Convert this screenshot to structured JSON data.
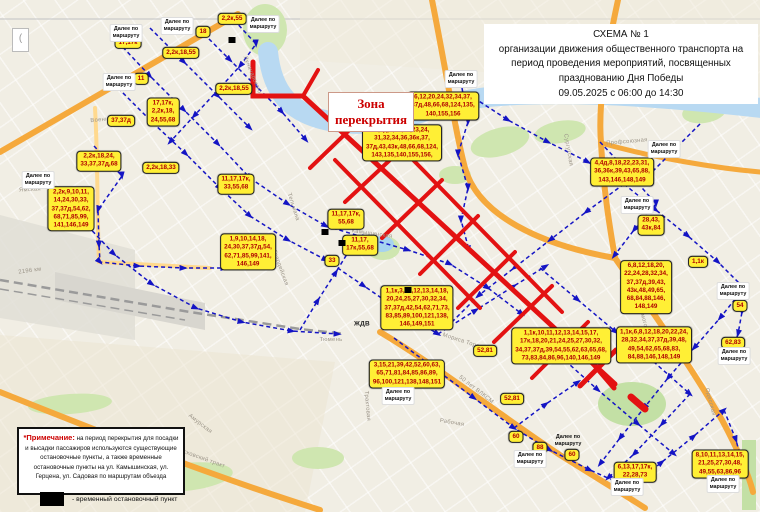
{
  "title": {
    "line1": "СХЕМА № 1",
    "line2": "организации движения общественного транспорта на",
    "line3": "период проведения мероприятий, посвященных",
    "line4": "празднованию Дня Победы",
    "line5": "09.05.2025 с 06:00 до 14:30"
  },
  "zone": {
    "line1": "Зона",
    "line2": "перекрытия"
  },
  "note": {
    "label": "*Примечание:",
    "body": " на период перекрытия для посадки и высадки пассажиров используются существующие остановочные пункты, а также временные остановочные пункты на ул. Камышинская, ул. Герцена, ул. Садовая по маршрутам объезда"
  },
  "legend": {
    "text": "- временный остановочный пункт"
  },
  "corner_glyph": "(",
  "colors": {
    "route_label_bg": "#ffef35",
    "route_label_text": "#b00000",
    "closure_red": "#e31212",
    "route_blue": "#1414c4",
    "road_orange": "#f5a93c",
    "river_blue": "#b8d9f2",
    "park_green": "#cfe6b0"
  },
  "map": {
    "info_label_text": "Далее по\nмаршруту",
    "route_labels": [
      {
        "t": "2,2к,55",
        "x": 232,
        "y": 19
      },
      {
        "t": "18",
        "x": 203,
        "y": 32
      },
      {
        "t": "17,17к",
        "x": 128,
        "y": 43
      },
      {
        "t": "2,2к,18,55",
        "x": 181,
        "y": 53
      },
      {
        "t": "11",
        "x": 141,
        "y": 79
      },
      {
        "t": "2,2к,18,55",
        "x": 234,
        "y": 89
      },
      {
        "t": "17,17к,\n2,2к,18,\n24,55,68",
        "x": 163,
        "y": 112
      },
      {
        "t": "37,37д",
        "x": 121,
        "y": 121
      },
      {
        "t": "2,2к,18,24,\n33,37,37д,68",
        "x": 99,
        "y": 161
      },
      {
        "t": "2,2к,18,33",
        "x": 161,
        "y": 168
      },
      {
        "t": "11,17,17к,\n33,55,68",
        "x": 236,
        "y": 184
      },
      {
        "t": "2,2к,9,10,11,\n14,24,30,33,\n37,37д,54,62,\n68,71,85,99,\n141,146,149",
        "x": 71,
        "y": 209
      },
      {
        "t": "1,9,10,14,18,\n24,30,37,37д,54,\n62,71,85,99,141,\n146,149",
        "x": 248,
        "y": 252
      },
      {
        "t": "6,12,20,24,32,34,37,\n37д,48,66,68,124,135,\n140,155,156",
        "x": 443,
        "y": 106
      },
      {
        "t": "4,4д,6,12,20,23,24,\n31,32,34,36,36к,37,\n37д,43,43к,48,66,68,124,\n143,135,140,155,156,",
        "x": 402,
        "y": 143
      },
      {
        "t": "11,17,17к,\n55,68",
        "x": 346,
        "y": 219
      },
      {
        "t": "11,17,\n17к,55,68",
        "x": 360,
        "y": 245
      },
      {
        "t": "33",
        "x": 332,
        "y": 261
      },
      {
        "t": "1,1к,3,10,12,13,14,18,\n20,24,25,27,30,32,34,\n37,37д,42,54,62,71,73,\n83,85,89,100,121,138,\n146,149,151",
        "x": 417,
        "y": 308
      },
      {
        "t": "4,4д,8,18,22,23,31,\n36,36к,39,43,65,88,\n143,146,148,149",
        "x": 622,
        "y": 172
      },
      {
        "t": "28,43,\n43к,84",
        "x": 651,
        "y": 225
      },
      {
        "t": "1,1к",
        "x": 698,
        "y": 262
      },
      {
        "t": "6,8,12,18,20,\n22,24,28,32,34,\n37,37д,39,43,\n43к,48,49,65,\n68,84,88,146,\n148,149",
        "x": 646,
        "y": 287
      },
      {
        "t": "1,1к,6,8,12,18,20,22,24,\n28,32,34,37,37д,39,48,\n49,54,62,65,68,83,\n84,88,146,148,149",
        "x": 654,
        "y": 345
      },
      {
        "t": "54",
        "x": 740,
        "y": 306
      },
      {
        "t": "62,83",
        "x": 733,
        "y": 343
      },
      {
        "t": "8,10,11,13,14,15,\n21,25,27,30,48,\n49,55,63,86,96",
        "x": 720,
        "y": 464
      },
      {
        "t": "6,13,17,17к,\n22,28,73",
        "x": 635,
        "y": 472
      },
      {
        "t": "3,15,21,39,42,52,60,63,\n65,71,81,84,85,86,89,\n96,100,121,138,148,151",
        "x": 407,
        "y": 374
      },
      {
        "t": "1,1к,10,11,12,13,14,15,17,\n17к,18,20,21,24,25,27,30,32,\n34,37,37д,39,54,55,62,63,65,68,\n73,83,84,86,96,140,146,149",
        "x": 561,
        "y": 346
      },
      {
        "t": "52,81",
        "x": 485,
        "y": 351
      },
      {
        "t": "52,81",
        "x": 512,
        "y": 399
      },
      {
        "t": "60",
        "x": 516,
        "y": 437
      },
      {
        "t": "88",
        "x": 540,
        "y": 448
      },
      {
        "t": "60",
        "x": 572,
        "y": 455
      }
    ],
    "info_labels": [
      {
        "x": 126,
        "y": 33
      },
      {
        "x": 177,
        "y": 26
      },
      {
        "x": 263,
        "y": 24
      },
      {
        "x": 119,
        "y": 82
      },
      {
        "x": 38,
        "y": 180
      },
      {
        "x": 461,
        "y": 79
      },
      {
        "x": 664,
        "y": 149
      },
      {
        "x": 637,
        "y": 205
      },
      {
        "x": 733,
        "y": 291
      },
      {
        "x": 734,
        "y": 356
      },
      {
        "x": 723,
        "y": 484
      },
      {
        "x": 627,
        "y": 487
      },
      {
        "x": 530,
        "y": 459
      },
      {
        "x": 568,
        "y": 441,
        "plain": true
      },
      {
        "x": 398,
        "y": 396
      }
    ],
    "street_labels": [
      {
        "t": "Военная",
        "x": 103,
        "y": 120,
        "r": -5
      },
      {
        "t": "Ямская",
        "x": 30,
        "y": 190,
        "r": -3
      },
      {
        "t": "Луначарского",
        "x": 252,
        "y": 75,
        "r": 68
      },
      {
        "t": "Тельмана",
        "x": 293,
        "y": 207,
        "r": 72
      },
      {
        "t": "Камышинская",
        "x": 372,
        "y": 234,
        "r": 8
      },
      {
        "t": "Гвардейская",
        "x": 280,
        "y": 268,
        "r": 70
      },
      {
        "t": "Мориса Тореза",
        "x": 464,
        "y": 342,
        "r": 18
      },
      {
        "t": "50 лет ВЛКСМ",
        "x": 476,
        "y": 390,
        "r": 38
      },
      {
        "t": "Рабочая",
        "x": 452,
        "y": 423,
        "r": 10
      },
      {
        "t": "Московский тракт",
        "x": 200,
        "y": 458,
        "r": 20
      },
      {
        "t": "Амурская",
        "x": 200,
        "y": 424,
        "r": 38
      },
      {
        "t": "Профсоюзная",
        "x": 627,
        "y": 142,
        "r": -5
      },
      {
        "t": "Сургутская",
        "x": 568,
        "y": 150,
        "r": 80
      },
      {
        "t": "Холмогорная",
        "x": 644,
        "y": 322,
        "r": 75
      },
      {
        "t": "Одесская",
        "x": 710,
        "y": 402,
        "r": 75
      },
      {
        "t": "Трактовая",
        "x": 367,
        "y": 406,
        "r": 85
      },
      {
        "t": "Тюмень",
        "x": 331,
        "y": 340,
        "r": 0
      },
      {
        "t": "2196 км",
        "x": 30,
        "y": 271,
        "r": -8
      },
      {
        "t": "ЖДВ",
        "x": 362,
        "y": 324,
        "r": 0,
        "bold": true
      }
    ],
    "stop_markers": [
      {
        "x": 232,
        "y": 40
      },
      {
        "x": 325,
        "y": 232
      },
      {
        "x": 342,
        "y": 243
      },
      {
        "x": 408,
        "y": 290
      }
    ]
  }
}
